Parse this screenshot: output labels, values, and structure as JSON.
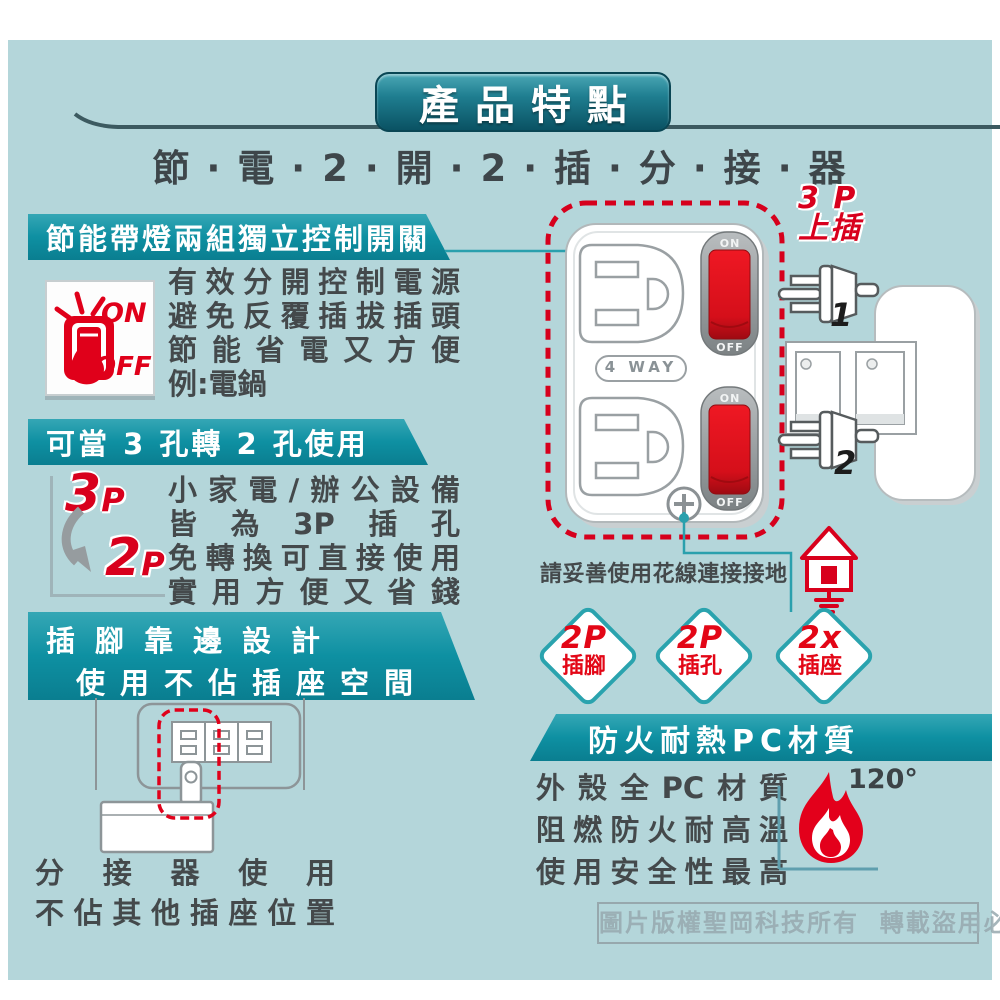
{
  "page": {
    "title_banner": "產品特點",
    "subtitle": "節 · 電 · 2 · 開 · 2 · 插 · 分 · 接 · 器",
    "watermark": "圖片版權聖岡科技所有  轉載盜用必究"
  },
  "colors": {
    "background": "#b4d6da",
    "banner_teal": "#0e90a2",
    "accent_red": "#e0001a",
    "text_dark": "#44494b",
    "line_teal": "#2aa0ad"
  },
  "sections": {
    "switch_control": {
      "banner": "節能帶燈兩組獨立控制開關",
      "icon_on": "ON",
      "icon_off": "OFF",
      "lines": [
        "有效分開控制電源",
        "避免反覆插拔插頭",
        "節能省電又方便",
        "例:電鍋"
      ]
    },
    "adapter_3to2": {
      "banner": "可當 3 孔轉 2 孔使用",
      "icon_from_num": "3",
      "icon_from_p": "P",
      "icon_to_num": "2",
      "icon_to_p": "P",
      "lines": [
        "小家電/辦公設備",
        "皆為3P插孔",
        "免轉換可直接使用",
        "實用方便又省錢"
      ]
    },
    "edge_design": {
      "banner_line1": "插腳靠邊設計",
      "banner_line2": "使用不佔插座空間",
      "caption_line1": "分接器使用",
      "caption_line2": "不佔其他插座位置"
    },
    "product": {
      "label_4way": "4 WAY",
      "switch_on": "ON",
      "switch_off": "OFF",
      "plug_note_line1": "3 P",
      "plug_note_line2": "上插",
      "plug1": "1",
      "plug2": "2",
      "ground_note": "請妥善使用花線連接接地"
    },
    "badges": [
      {
        "top": "2P",
        "bottom": "插腳"
      },
      {
        "top": "2P",
        "bottom": "插孔"
      },
      {
        "top": "2x",
        "bottom": "插座"
      }
    ],
    "fireproof": {
      "banner": "防火耐熱PC材質",
      "lines": [
        "外殼全PC材質",
        "阻燃防火耐高溫",
        "使用安全性最高"
      ],
      "temp": "120°"
    }
  }
}
